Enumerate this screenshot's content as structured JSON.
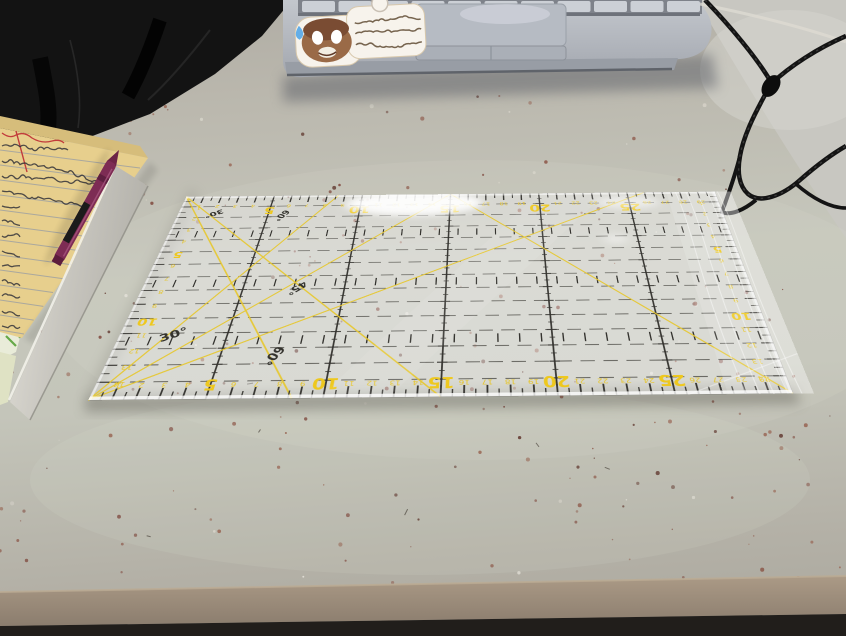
{
  "ruler": {
    "edge_numbers": [
      1,
      2,
      3,
      4,
      5,
      6,
      7,
      8,
      9,
      10,
      11,
      12,
      13,
      14,
      15,
      16,
      17,
      18,
      19,
      20,
      21,
      22,
      23,
      24,
      25,
      26,
      27,
      28,
      29
    ],
    "emphasized_edge_numbers": [
      5,
      10,
      15,
      20,
      25
    ],
    "side_numbers": [
      1,
      2,
      3,
      4,
      5,
      6,
      7,
      8,
      9,
      10,
      11,
      12,
      13,
      14
    ],
    "emphasized_side_numbers": [
      5,
      10
    ],
    "angle_labels_upright": [
      "30°",
      "60°"
    ],
    "angle_labels_reversed": [
      "30°",
      "60°",
      "45°"
    ],
    "length_cm": 30,
    "width_cm": 15,
    "colors": {
      "markings": "#34332f",
      "accent_yellow": "#e6c52c",
      "big_number_yellow": "#eec81e",
      "body_tint": "rgba(250,250,252,0.35)"
    }
  },
  "notepad": {
    "paper_color": "#e7cf8d",
    "ruled_line_count": 13,
    "handwriting_legible": false,
    "handwriting_line_lengths": [
      0.5,
      0.85,
      0.88,
      0.8,
      0.22,
      0.2,
      0.22,
      0.24,
      0.3,
      0.33,
      0.3,
      0.34,
      0.3
    ],
    "margin_line_color": "#c23b3b"
  },
  "pen": {
    "body_color": "#7d2c54",
    "clip_color": "#1b1b1b"
  },
  "desk": {
    "surface_color": "#c2c3b8",
    "front_edge_color": "#9a8b7b",
    "under_edge_color": "#211e1b",
    "speckle_colors": [
      "#7c4338",
      "#8a5243",
      "#5f352c",
      "#96604e",
      "#e8e5dc",
      "#d9d6cc"
    ]
  },
  "laptop": {
    "body_color": "#b4b8bf",
    "trackpad_color": "#b6bbc3"
  },
  "cords": {
    "color": "#161616"
  },
  "back_surface_color": "#c8c7c1",
  "black_bag_color": "#131313",
  "green_paper": {
    "paper_color": "#e9ecd9",
    "ink_color": "#4f9e2f"
  }
}
